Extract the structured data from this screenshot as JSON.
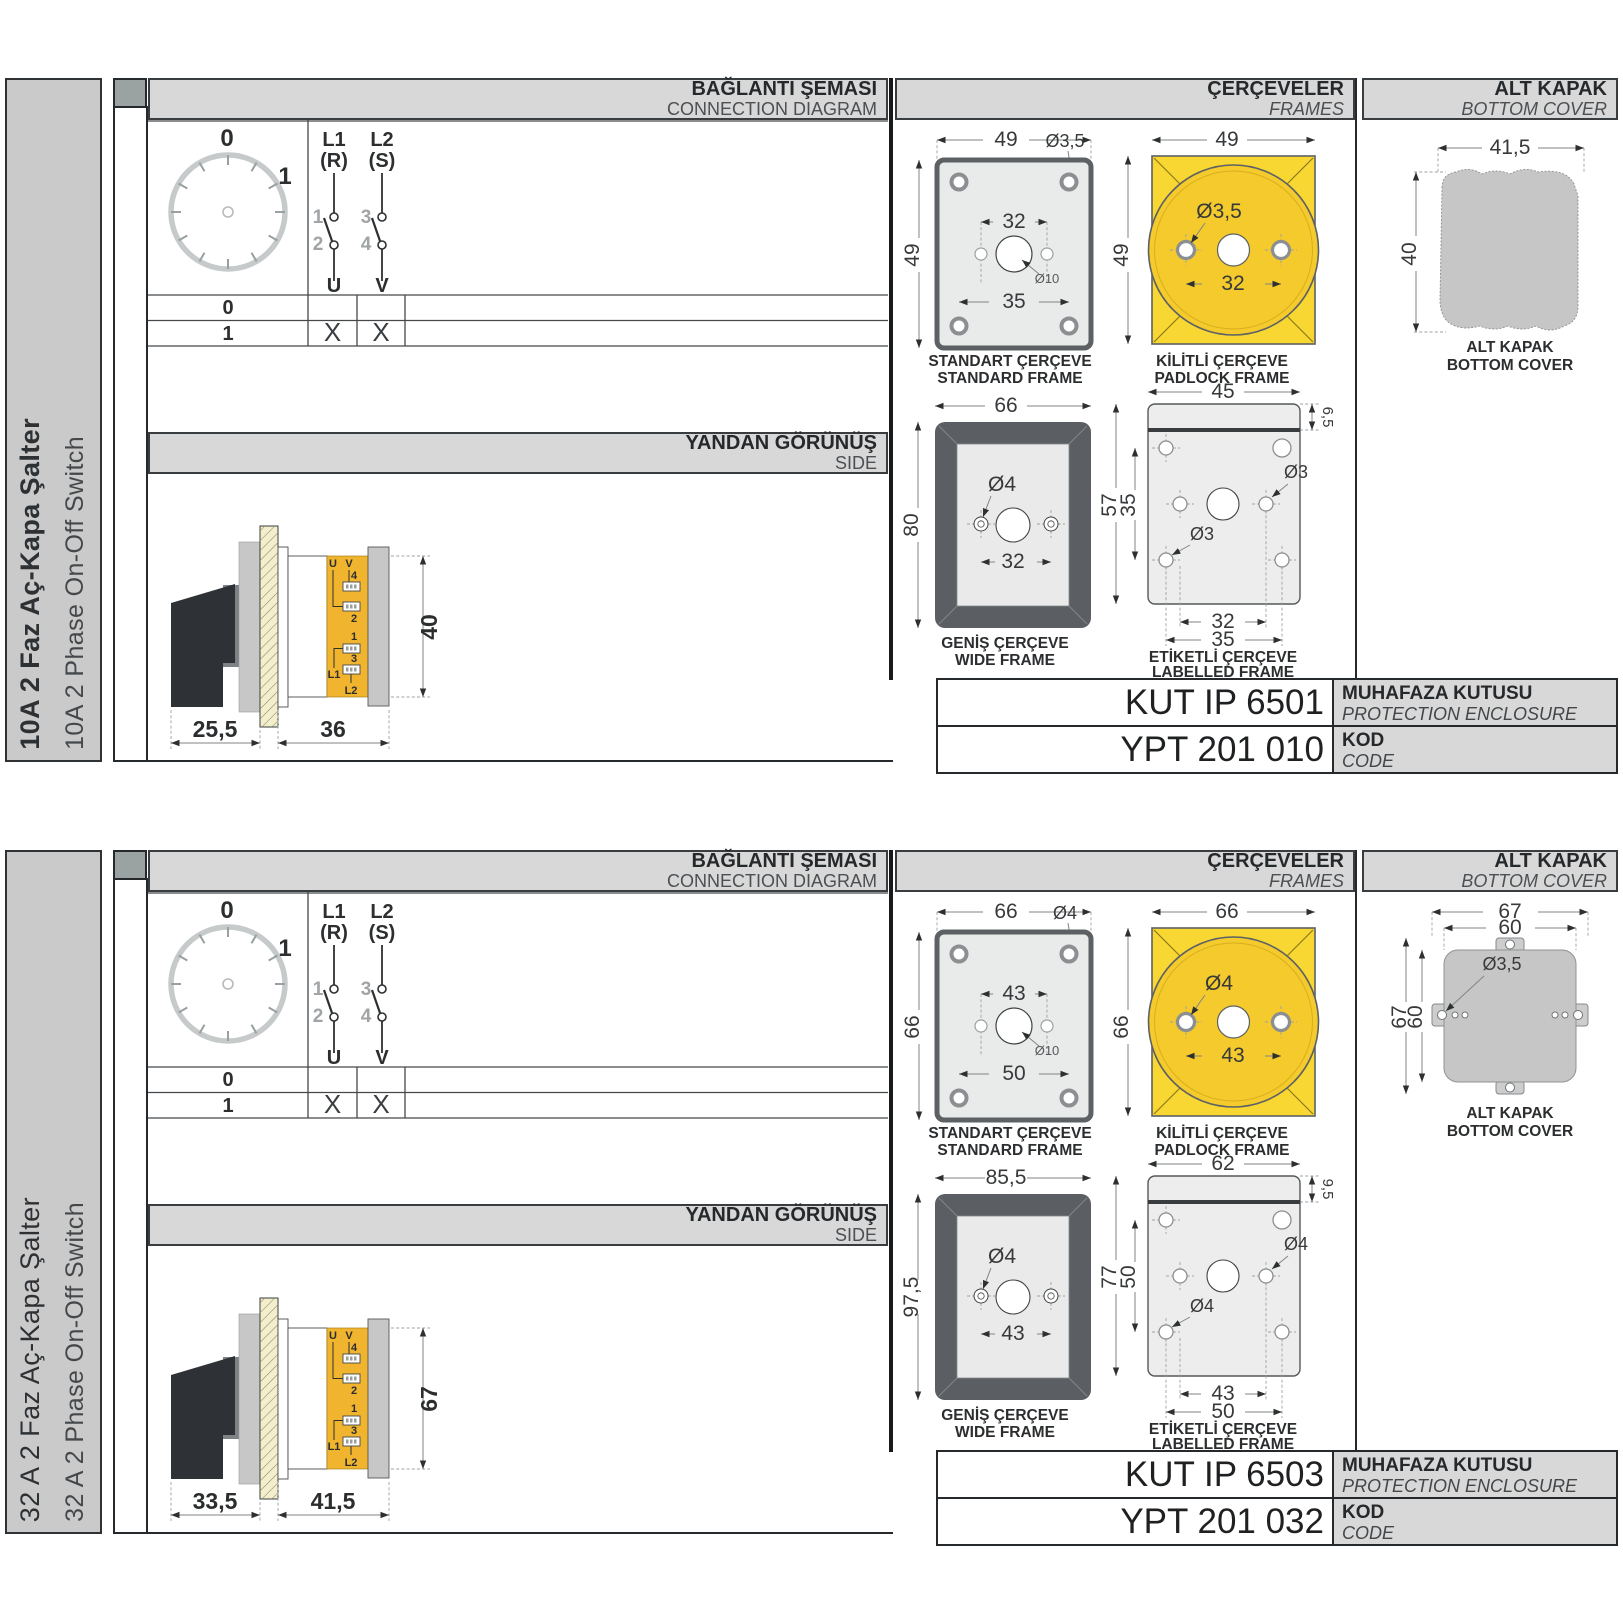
{
  "sections": [
    {
      "side_label_tr": "10A 2 Faz Aç-Kapa Şalter",
      "side_label_en": "10A 2 Phase On-Off Switch",
      "headers": {
        "diagram_tr": "BAĞLANTI ŞEMASI",
        "diagram_en": "CONNECTION DIAGRAM",
        "frames_tr": "ÇERÇEVELER",
        "frames_en": "FRAMES",
        "cover_tr": "ALT KAPAK",
        "cover_en": "BOTTOM COVER",
        "side_tr": "YANDAN GÖRÜNÜŞ",
        "side_en": "SIDE"
      },
      "diagram": {
        "pos0": "0",
        "pos1": "1",
        "l1": "L1",
        "l1_phase": "(R)",
        "l2": "L2",
        "l2_phase": "(S)",
        "t1": "1",
        "t2": "2",
        "t3": "3",
        "t4": "4",
        "u": "U",
        "v": "V",
        "rows": [
          {
            "label": "0",
            "u": "",
            "v": ""
          },
          {
            "label": "1",
            "u": "X",
            "v": "X"
          }
        ]
      },
      "side_view": {
        "dim_front": "25,5",
        "dim_body": "36",
        "dim_height": "40",
        "u": "U",
        "v": "V",
        "n4": "4",
        "n2": "2",
        "n1": "1",
        "n3": "3",
        "l1": "L1",
        "l2": "L2"
      },
      "frames": {
        "standard": {
          "title_tr": "STANDART ÇERÇEVE",
          "title_en": "STANDARD FRAME",
          "w": "49",
          "h": "49",
          "hole": "Ø3,5",
          "center_hole": "Ø10",
          "span_inner": "32",
          "span_outer": "35"
        },
        "padlock": {
          "title_tr": "KİLİTLİ ÇERÇEVE",
          "title_en": "PADLOCK FRAME",
          "w": "49",
          "h": "49",
          "hole": "Ø3,5",
          "span": "32"
        },
        "wide": {
          "title_tr": "GENİŞ ÇERÇEVE",
          "title_en": "WIDE FRAME",
          "w": "66",
          "h": "80",
          "hole": "Ø4",
          "span": "32"
        },
        "labelled": {
          "title_tr": "ETİKETLİ ÇERÇEVE",
          "title_en": "LABELLED FRAME",
          "w": "45",
          "h": "57",
          "h_inner": "35",
          "tab": "6,5",
          "hole_right": "Ø3",
          "hole_left": "Ø3",
          "span_inner": "32",
          "span_outer": "35"
        }
      },
      "cover": {
        "variant": "scalloped",
        "title_tr": "ALT KAPAK",
        "title_en": "BOTTOM COVER",
        "a_w": "41,5",
        "a_h": "40"
      },
      "enclosure": {
        "code": "KUT IP 6501",
        "label_tr": "MUHAFAZA KUTUSU",
        "label_en": "PROTECTION ENCLOSURE"
      },
      "kod": {
        "code": "YPT 201 010",
        "label_tr": "KOD",
        "label_en": "CODE"
      }
    },
    {
      "side_label_tr": "32 A 2 Faz Aç-Kapa Şalter",
      "side_label_en": "32 A 2 Phase On-Off Switch",
      "headers": {
        "diagram_tr": "BAĞLANTI ŞEMASI",
        "diagram_en": "CONNECTION DIAGRAM",
        "frames_tr": "ÇERÇEVELER",
        "frames_en": "FRAMES",
        "cover_tr": "ALT KAPAK",
        "cover_en": "BOTTOM COVER",
        "side_tr": "YANDAN GÖRÜNÜŞ",
        "side_en": "SIDE"
      },
      "diagram": {
        "pos0": "0",
        "pos1": "1",
        "l1": "L1",
        "l1_phase": "(R)",
        "l2": "L2",
        "l2_phase": "(S)",
        "t1": "1",
        "t2": "2",
        "t3": "3",
        "t4": "4",
        "u": "U",
        "v": "V",
        "rows": [
          {
            "label": "0",
            "u": "",
            "v": ""
          },
          {
            "label": "1",
            "u": "X",
            "v": "X"
          }
        ]
      },
      "side_view": {
        "dim_front": "33,5",
        "dim_body": "41,5",
        "dim_height": "67",
        "u": "U",
        "v": "V",
        "n4": "4",
        "n2": "2",
        "n1": "1",
        "n3": "3",
        "l1": "L1",
        "l2": "L2"
      },
      "frames": {
        "standard": {
          "title_tr": "STANDART ÇERÇEVE",
          "title_en": "STANDARD FRAME",
          "w": "66",
          "h": "66",
          "hole": "Ø4",
          "center_hole": "Ø10",
          "span_inner": "43",
          "span_outer": "50"
        },
        "padlock": {
          "title_tr": "KİLİTLİ ÇERÇEVE",
          "title_en": "PADLOCK FRAME",
          "w": "66",
          "h": "66",
          "hole": "Ø4",
          "span": "43"
        },
        "wide": {
          "title_tr": "GENİŞ ÇERÇEVE",
          "title_en": "WIDE FRAME",
          "w": "85,5",
          "h": "97,5",
          "hole": "Ø4",
          "span": "43"
        },
        "labelled": {
          "title_tr": "ETİKETLİ ÇERÇEVE",
          "title_en": "LABELLED FRAME",
          "w": "62",
          "h": "77",
          "h_inner": "50",
          "tab": "9,5",
          "hole_right": "Ø4",
          "hole_left": "Ø4",
          "span_inner": "43",
          "span_outer": "50"
        }
      },
      "cover": {
        "variant": "tabbed",
        "title_tr": "ALT KAPAK",
        "title_en": "BOTTOM COVER",
        "b_w_outer": "67",
        "b_w_inner": "60",
        "b_h_outer": "67",
        "b_h_inner": "60",
        "b_hole": "Ø3,5"
      },
      "enclosure": {
        "code": "KUT IP 6503",
        "label_tr": "MUHAFAZA KUTUSU",
        "label_en": "PROTECTION ENCLOSURE"
      },
      "kod": {
        "code": "YPT 201 032",
        "label_tr": "KOD",
        "label_en": "CODE"
      }
    }
  ]
}
